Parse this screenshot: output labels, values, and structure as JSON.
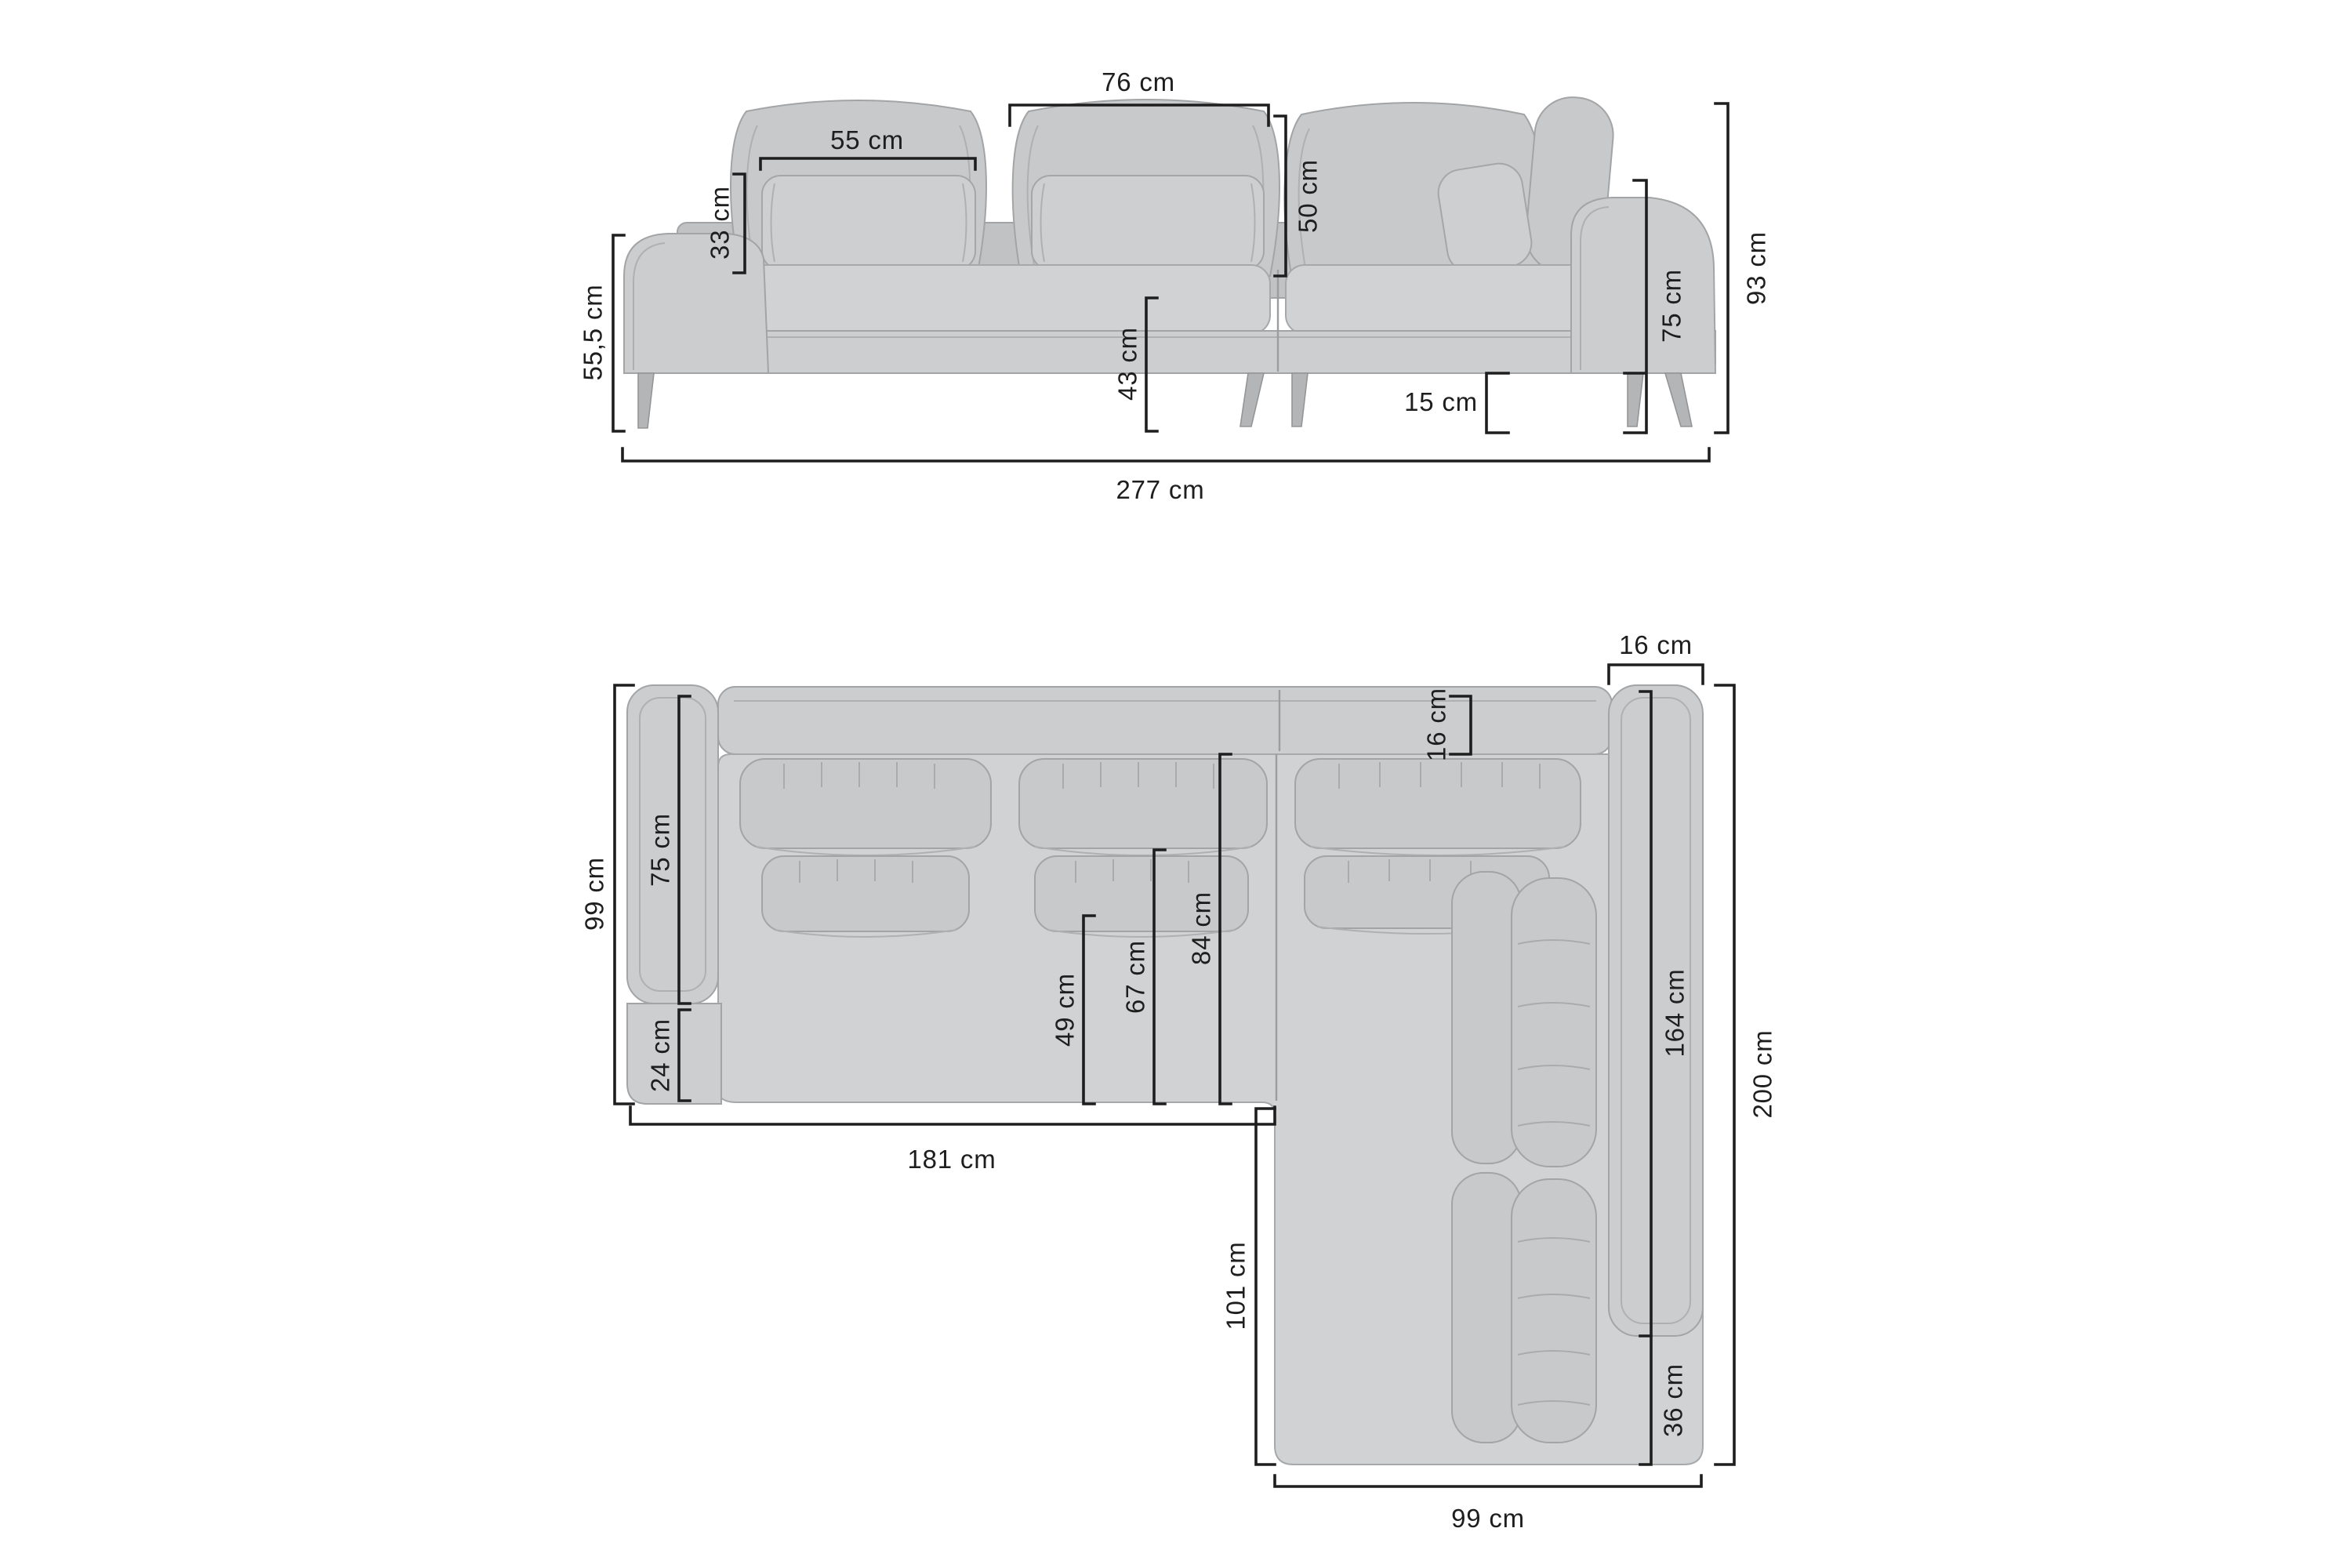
{
  "diagram": {
    "subject": "corner-sofa-with-dimensions",
    "unit": "cm",
    "colors": {
      "background": "#ffffff",
      "sofa_gray": "#cccecf",
      "dimension_lines": "#1e1e1e"
    },
    "front_view": {
      "labels": {
        "back_cushion_width": "76 cm",
        "pillow_width": "55 cm",
        "pillow_height": "33 cm",
        "back_cushion_height": "50 cm",
        "armrest_height": "55,5 cm",
        "seat_height": "43 cm",
        "leg_height": "15 cm",
        "backrest_height": "75 cm",
        "total_height": "93 cm",
        "total_width": "277 cm"
      }
    },
    "top_view": {
      "labels": {
        "armrest_width": "16 cm",
        "backrest_depth": "16 cm",
        "left_side_depth": "99 cm",
        "left_armrest_length": "75 cm",
        "front_ledge_depth": "24 cm",
        "seat_depth_to_lumbar": "49 cm",
        "seat_depth_to_cushion": "67 cm",
        "seat_depth_full": "84 cm",
        "main_body_width": "181 cm",
        "chaise_side_length": "101 cm",
        "right_armrest_length": "164 cm",
        "total_depth": "200 cm",
        "corner_section": "36 cm",
        "chaise_width": "99 cm"
      }
    }
  }
}
